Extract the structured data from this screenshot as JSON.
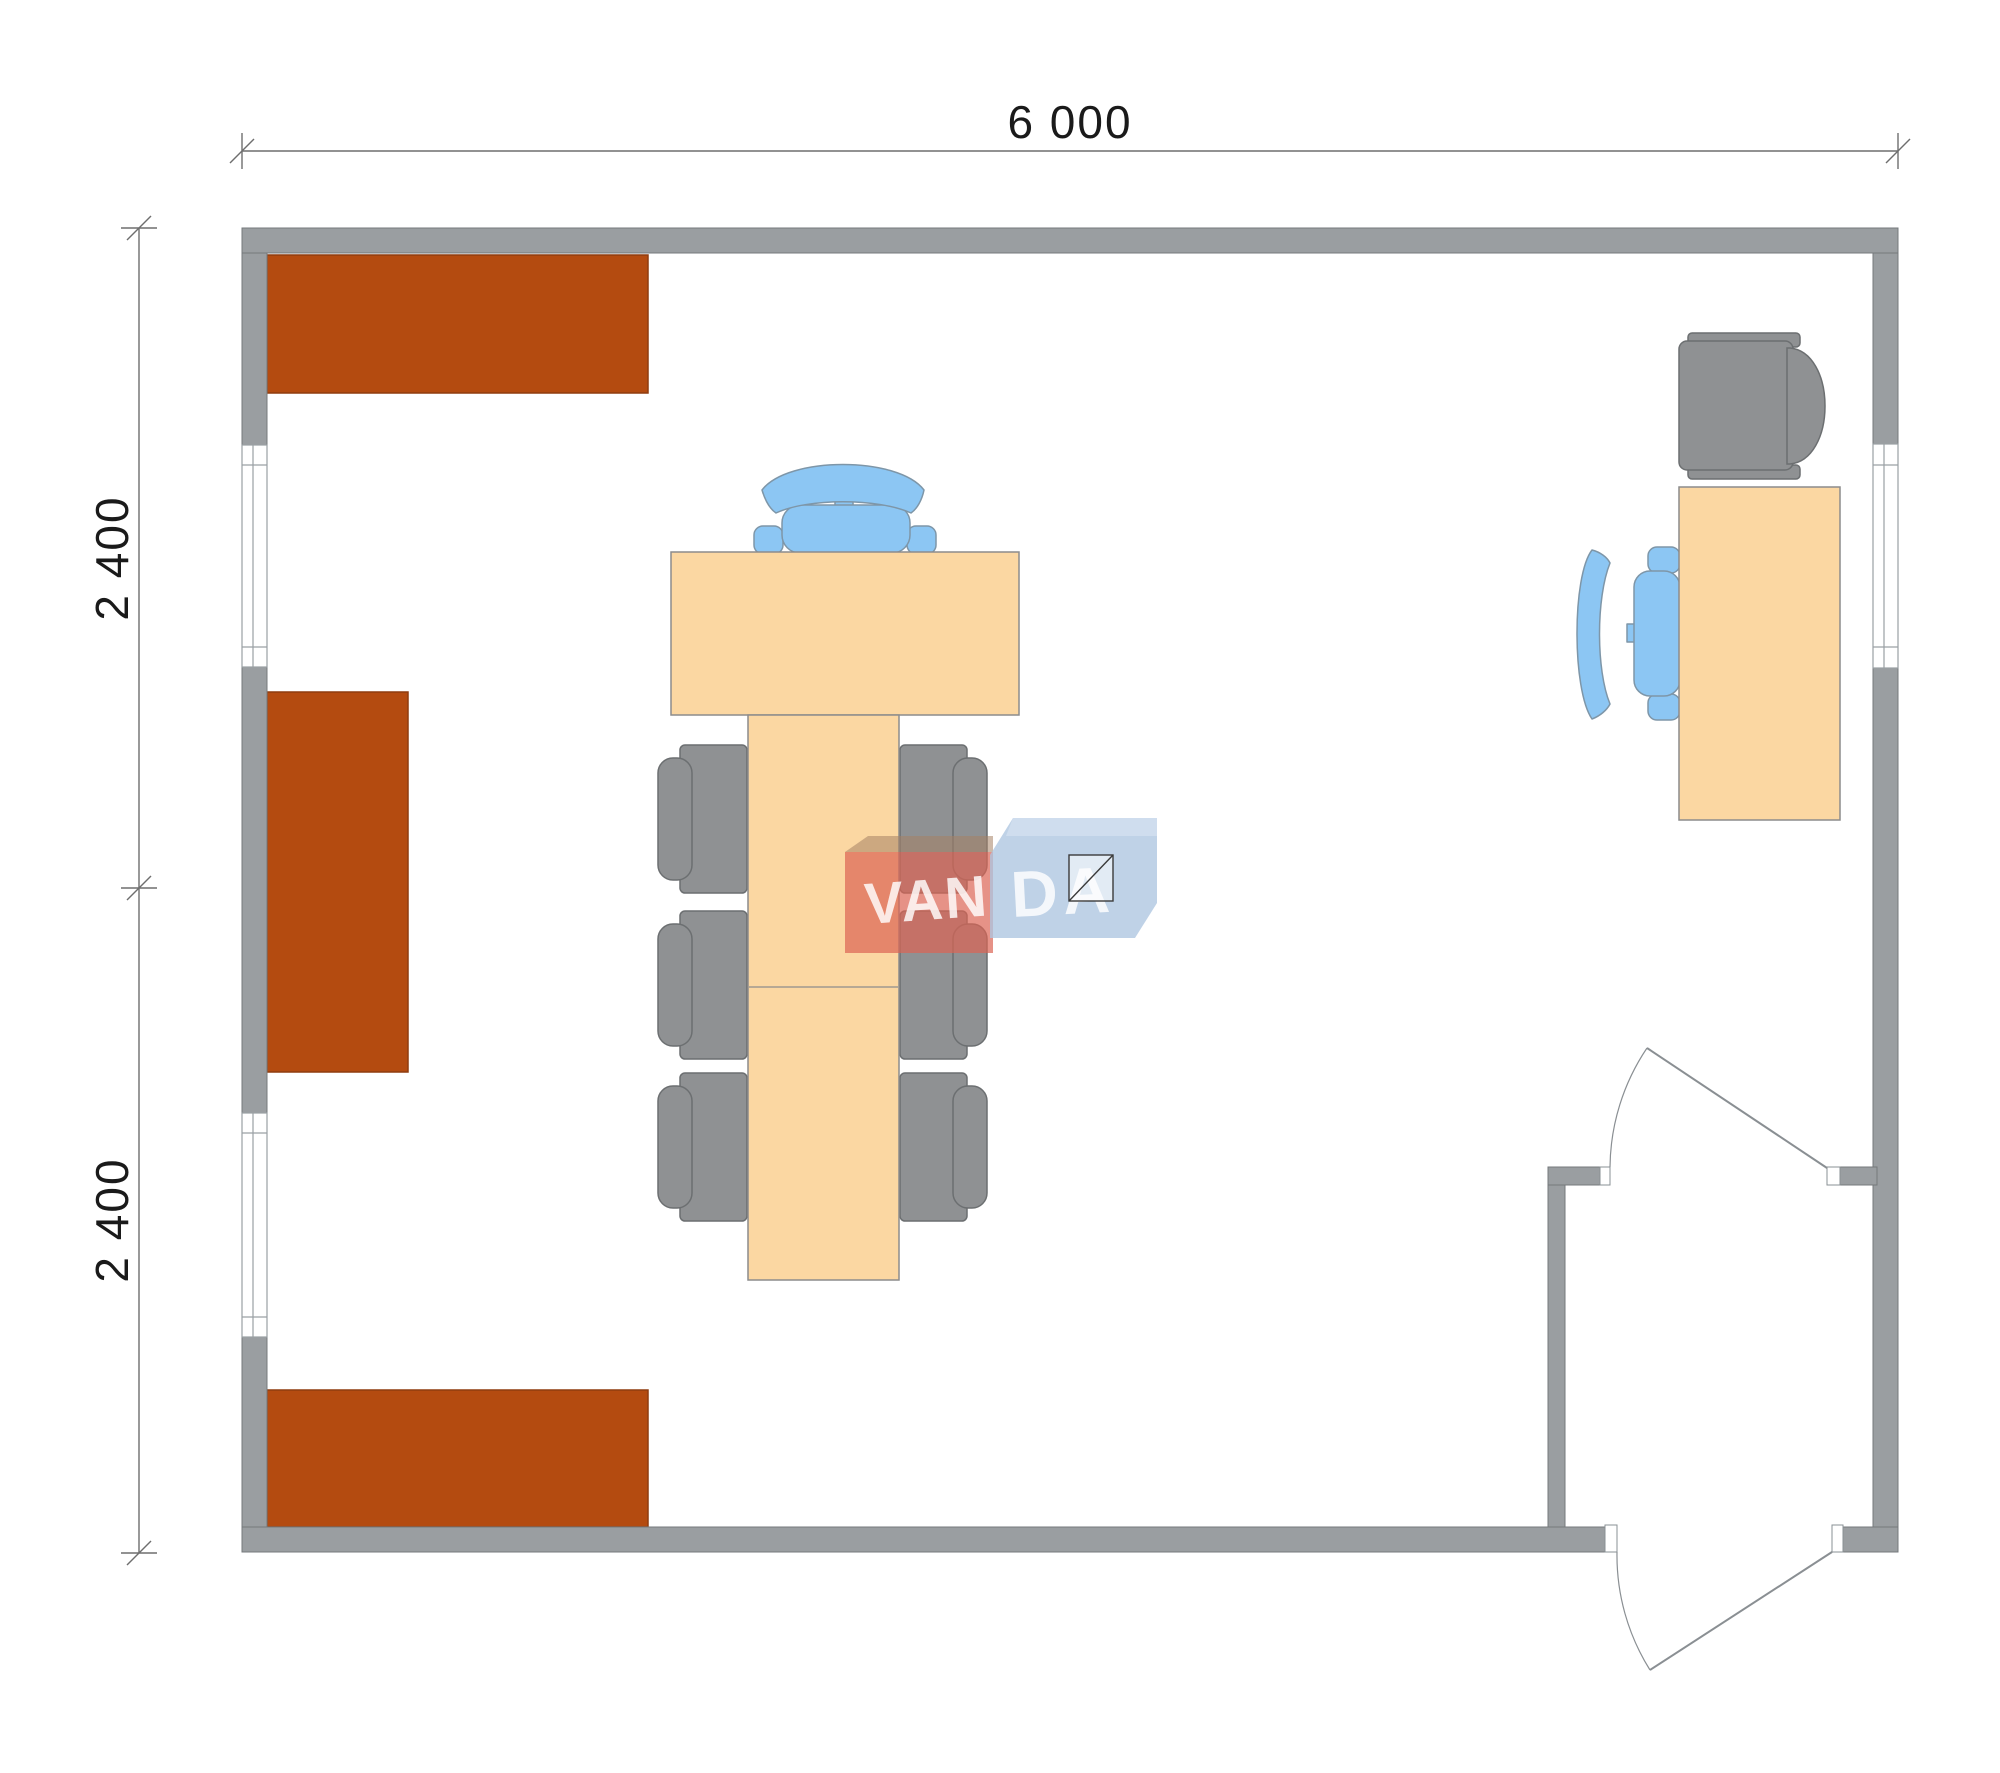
{
  "page": {
    "type": "architectural floor plan, top view",
    "background": "#FFFFFF"
  },
  "dimensions": {
    "top_width": "6 000",
    "left_height_upper": "2 400",
    "left_height_lower": "2 400"
  },
  "watermark": {
    "brand_left": "VAN",
    "brand_right": "DA"
  },
  "colors": {
    "wall": "#9A9EA1",
    "wall_outline": "#75797C",
    "cabinet": "#B44B10",
    "cabinet_outline": "#8F3C0F",
    "table": "#FBD7A2",
    "table_outline": "#8C8C8C",
    "chair_gray": "#8F9193",
    "chair_gray_outline": "#6C6F71",
    "chair_blue": "#8CC6F3",
    "chair_blue_outline": "#7E96A8",
    "dimension_line": "#6E6E6E",
    "dimension_text": "#1A1A1A",
    "door_line": "#8A8F93",
    "window_line": "#9AA0A4",
    "watermark_red": "rgba(219,100,84,0.70)",
    "watermark_red_top": "rgba(165,130,100,0.55)",
    "watermark_blue": "rgba(173,197,224,0.78)",
    "watermark_text": "rgba(255,255,255,0.82)"
  },
  "plan": {
    "outer_width_mm": 6000,
    "outer_height_mm": 4800,
    "furniture": {
      "wall_cabinets": 3,
      "meeting_table_sections": 3,
      "meeting_chairs_gray": 6,
      "meeting_chair_blue": 1,
      "desk": 1,
      "desk_chair_gray": 1,
      "desk_chair_blue": 1
    },
    "openings": {
      "windows": 3,
      "doors": 2
    }
  }
}
